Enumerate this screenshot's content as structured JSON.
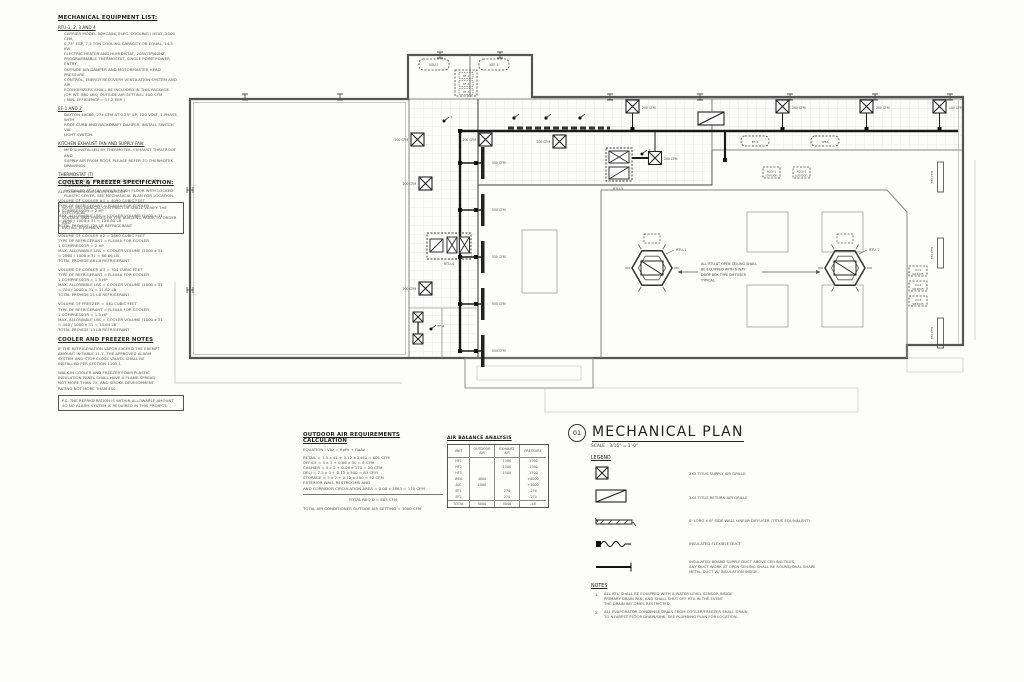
{
  "equipment_list": {
    "title": "MECHANICAL EQUIPMENT LIST:",
    "sections": [
      {
        "heading": "RTU-1, 2, 3 AND 4",
        "body": "CARRIER MODEL 50HCA06, ELEC. COOLING / HEAT, 2000 CFM,\n0.75\" ESP, 7.5 TON COOLING CAPACITY OR EQUAL, 14.5 KW\nELECTRIC HEATER AND HUMIDISTAT, 208V/3P/60HZ,\nPROGRAMMABLE THERMOSTAT, SINGLE POINT POWER ENTRY,\nOUTSIDE AIR DAMPER AND MOTORMASTER HEAD PRESSURE\nCONTROL, ENERGY RECOVERY VENTILATION SYSTEM AND AIR\nECONOMIZERS SHALL BE INCLUDED IN THIS PACKAGE.\n(OP. WT. 860 LBS)  OUTSIDE AIR SETTING: 400 CFM\n( MIN. EFFICIENCY = 11.2 EER )"
      },
      {
        "heading": "EF-1 AND 2",
        "body": "DAYTON 4XC66, 274 CFM AT 0.25\" SP, 120 VOLT, 1-PHASE, WITH\nROOF CURB AND BACKDRAFT DAMPER. INSTALL SWITCH VIA\nLIGHT SWITCH."
      },
      {
        "heading": "KITCHEN EXHAUST FAN AND SUPPLY FAN:",
        "body": "MFD & INSTALLED BY THERMOTEK. EXHAUST THRU ROOF AND\nSUPPLY AIR FROM ROOF. PLEASE REFER TO THERMOTEK DRAWINGS."
      },
      {
        "heading": "THERMOSTAT (T)",
        "body": "\"HONEYWELL\" TPX4000 PROGRAMMABLE DIGITAL THERMOSTAT\nINSTALLED AT 4'-6\" ABOVE FINISH FLOOR WITH LOCKED\nPLASTIC COVER. SEE MECHANICAL PLAN FOR LOCATION."
      }
    ],
    "note_box": "NOTE: MECHANICAL CONTRACTOR SHALL VERIFY THE ELECTRICAL\nVOLTAGE AND PHASES OF THE BUILDING PRIOR TO ORDER AND\nINSTALL EQUIPMENT."
  },
  "cooler_spec": {
    "title": "COOLER & FREEZER SPECIFICATION:",
    "subtitle": "ALL COMPRESSOR UNITS ON ROOF",
    "paragraphs": [
      "VOLUME OF COOLER #1 = 4090 CUBIC FEET\nTYPE OF REFRIGERANT = R-404A FOR COOLER\n1 COMPRESSOR = 2 HP\nMAX. ALLOWABLE LBS = COOLER VOLUME /1000 x 31\n= 4090 / 1000 x 31 = 126.80 LB\nTOTAL PROVIDE 125 LB REFRIGERANT",
      "VOLUME OF COOLER #2 = 2860 CUBIC FEET\nTYPE OF REFRIGERANT = R-404A FOR COOLER\n1 COMPRESSOR = 2 HP\nMAX. ALLOWABLE LBS = COOLER VOLUME /1000 x 31\n= 2860 / 1000 x 31 = 88.66 LB\nTOTAL PROVIDE 88 LB REFRIGERANT",
      "VOLUME OF COOLER #3 = 704 CUBIC FEET\nTYPE OF REFRIGERANT = R-404A FOR COOLER\n1 COMPRESSOR = 1.5 HP\nMAX. ALLOWABLE LBS = COOLER VOLUME /1000 x 31\n= 704 / 1000 x 31 = 21.82 LB\nTOTAL PROVIDE 21 LB REFRIGERANT",
      "VOLUME OF FREEZER = 440 CUBIC FEET\nTYPE OF REFRIGERANT = R-404A FOR COOLER\n1 COMPRESSOR = 1.5 HP\nMAX. ALLOWABLE LBS = COOLER VOLUME /1000 x 31\n= 440 / 1000 x 31 = 13.64 LB\nTOTAL PROVIDE 13 LB REFRIGERANT"
    ]
  },
  "cooler_notes": {
    "title": "COOLER AND FREEZER NOTES",
    "paragraphs": [
      "IF THE REFRIGERATION VAPOR EXCEED THE EXEMPT\nAMOUNT IN TABLE 11-1, THE APPROVED ALARM\nSYSTEM AND STOP CLOSE VALVES SHALL BE\nINSTALLED PER  SECTION 1105.1",
      "WALK-IN COOLER AND FREEZER FOAM PLASTIC\nINSULATION PANEL SHALL HAVE A FLAME SPREAD\nNOT MORE THAN 75, AND SMOKE DEVELOPMENT\nRATING NOT MORE THAN 450"
    ],
    "ps_box": "P.S. THE REFRIGERATION IS WITHIN ALLOWABLE AMOUNT\nSO NO ALARM SYSTEM IS REQUIRED IN THIS PROJECT."
  },
  "outdoor_air": {
    "title": "OUTDOOR AIR REQUIREMENTS CALCULATION",
    "equation": "EQUATION :  Vbz = RpPz + RaAz",
    "body": "RETAIL = 7.5 x 41 + 0.12 x 2440 = 601 CFM\nOFFICE = 5 x 1 + 0.06 x 50 = 8 CFM\nCASHIER = 5 x 2 + 0.06 x 170 = 20 CFM\nDELI = 7.5 x 3 + 0.12 x 500 = 83 CFM\nSTORAGE = 5 x 2 + 0.12 x 350 = 52 CFM\nEXTERIOR WALL RESTROOMS AND\nAND CORRIDOR CIRCULATION AREA = 0.06 x 1883 = 110 CFM",
    "total": "TOTAL REQ'D = 883 CFM",
    "setting": "TOTAL AIR CONDITIONER OUTSIDE AIR SETTING  = 1000 CFM"
  },
  "air_balance": {
    "title": "AIR BALANCE ANALYSIS",
    "columns": [
      "UNIT",
      "OUTDOOR AIR",
      "EXHAUST AIR",
      "PRESSURE"
    ],
    "rows": [
      [
        "HF1",
        "",
        "1500",
        "-1500"
      ],
      [
        "HF2",
        "",
        "1500",
        "-1500"
      ],
      [
        "HF3",
        "",
        "1500",
        "-1500"
      ],
      [
        "WEA",
        "4000",
        "",
        "+4000"
      ],
      [
        "A/C",
        "1000",
        "",
        "+1000"
      ],
      [
        "EF1",
        "",
        "274",
        "-274"
      ],
      [
        "EF2",
        "",
        "274",
        "-274"
      ]
    ],
    "total": [
      "TOTAL",
      "5000",
      "5048",
      "-48"
    ]
  },
  "titleblock": {
    "number": "01",
    "title": "MECHANICAL PLAN",
    "scale": "SCALE : 3/16\" = 1'-0\"",
    "legend_title": "LEGEND",
    "legend": [
      "2X2 TITUS SUPPLY AIR GRILLE",
      "2X4 TITUS RETURN AIR GRILLE",
      "6' LONG x 6\" SIDE WALL LINEAR DIFFUSER (TITUS EQUIVALENT)",
      "INSULATED FLEXIBLE DUCT",
      "INSULATED BOARD SUPPLY DUCT ABOVE CEILING TILES,\nANY DUCT WORK AT OPEN CEILING SHALL BE ROUND/OVAL SHAPE\nMETAL DUCT W/ INSULATION INSIDE."
    ],
    "notes_title": "NOTES",
    "notes": [
      {
        "num": "1.",
        "text": "ALL RTU SHALL BE EQUIPPED WITH A WATER LEVEL SENSOR INSIDE\nPRIMARY DRAIN PAN, AND SHALL SHUT OFF RTU IN THE EVENT\nTHE DRAIN BECOMES RESTRICTED."
      },
      {
        "num": "2.",
        "text": "ALL EVAPORATOR CONDENSE DRAIN FROM COOLER/FREEZER SHALL DRAIN\nTO NEAREST FLOOR DRAIN/SINK. SEE PLUMBING PLAN FOR LOCATION."
      }
    ]
  },
  "plan": {
    "open_note": [
      "ALL RTU AT OPEN CEILING SHALL",
      "BE EQUIPPED WITH 6-WAY",
      "DROP BOX TYPE DIFFUSER",
      "TYPICAL"
    ],
    "labels": {
      "cfm550": "550 CFM",
      "cfm200": "200 CFM",
      "cfm100": "100 CFM",
      "rtu1": "RTU-1",
      "rtu2": "RTU-2",
      "rtu3": "RTU-3",
      "rtu4": "RTU-4",
      "ksu1": "KSU-1",
      "kef1": "KEF-1",
      "hf1": "HF-1",
      "hf2": "HF-2",
      "hf3": "HF-3",
      "ef1": "EF-1",
      "ef2": "EF-2",
      "wea": "WEA",
      "accu1": "ACCU-1",
      "accu2": "ACCU-2",
      "cu1": "CU-1",
      "cu2": "CU-2",
      "cu3": "CU-3",
      "on_roof": "(ON ROOF)",
      "t": "T"
    }
  }
}
